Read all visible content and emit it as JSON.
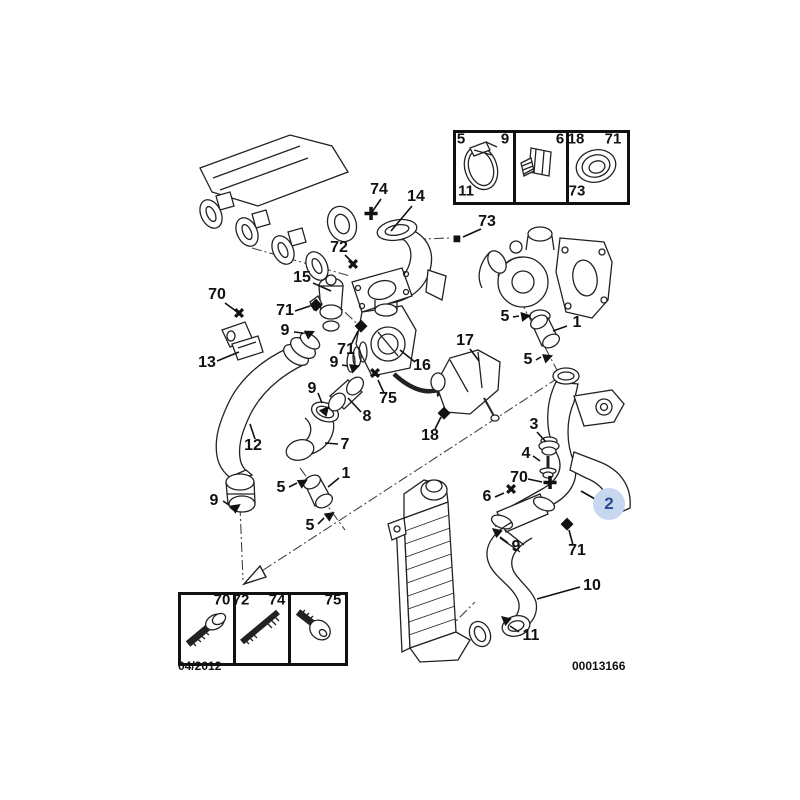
{
  "meta": {
    "date": "04/2012",
    "doc_number": "00013166"
  },
  "colors": {
    "line": "#222222",
    "background": "#ffffff",
    "highlight_circle": "#c7d7ef",
    "highlight_text": "#2a4a8c"
  },
  "icons": {
    "clamp_arrow": "▶",
    "screw_cross": "✖",
    "stud_plus": "✚",
    "seal_diamond": "◆",
    "nut_square": "■"
  },
  "highlighted_callout": {
    "label": "2"
  },
  "callouts": [
    {
      "label": "74",
      "marker": "stud_plus"
    },
    {
      "label": "14",
      "marker": "none"
    },
    {
      "label": "73",
      "marker": "nut_square"
    },
    {
      "label": "72",
      "marker": "screw_cross"
    },
    {
      "label": "15",
      "marker": "none"
    },
    {
      "label": "70",
      "marker": "screw_cross"
    },
    {
      "label": "71",
      "marker": "seal_diamond"
    },
    {
      "label": "9",
      "marker": "clamp_arrow"
    },
    {
      "label": "13",
      "marker": "none"
    },
    {
      "label": "71",
      "marker": "seal_diamond"
    },
    {
      "label": "9",
      "marker": "clamp_arrow"
    },
    {
      "label": "16",
      "marker": "none"
    },
    {
      "label": "75",
      "marker": "screw_cross"
    },
    {
      "label": "9",
      "marker": "clamp_arrow"
    },
    {
      "label": "8",
      "marker": "none"
    },
    {
      "label": "17",
      "marker": "none"
    },
    {
      "label": "18",
      "marker": "seal_diamond"
    },
    {
      "label": "7",
      "marker": "none"
    },
    {
      "label": "12",
      "marker": "none"
    },
    {
      "label": "5",
      "marker": "clamp_arrow"
    },
    {
      "label": "1",
      "marker": "none"
    },
    {
      "label": "9",
      "marker": "clamp_arrow"
    },
    {
      "label": "5",
      "marker": "clamp_arrow"
    },
    {
      "label": "5",
      "marker": "clamp_arrow"
    },
    {
      "label": "1",
      "marker": "none"
    },
    {
      "label": "5",
      "marker": "clamp_arrow"
    },
    {
      "label": "3",
      "marker": "none"
    },
    {
      "label": "4",
      "marker": "none"
    },
    {
      "label": "70",
      "marker": "stud_plus"
    },
    {
      "label": "6",
      "marker": "screw_cross"
    },
    {
      "label": "71",
      "marker": "seal_diamond"
    },
    {
      "label": "9",
      "marker": "clamp_arrow"
    },
    {
      "label": "10",
      "marker": "none"
    },
    {
      "label": "11",
      "marker": "clamp_arrow"
    }
  ],
  "inset_top_right": {
    "cell1": {
      "top_left": "5",
      "top_right": "9",
      "bottom_left": "11",
      "part": "hose-clamp"
    },
    "cell2": {
      "top_right": "6",
      "part": "threaded-adapter"
    },
    "cell3": {
      "top_left": "18",
      "top_right": "71",
      "bottom_left": "73",
      "part": "seal-grommet"
    }
  },
  "inset_bottom_left": {
    "cell1": {
      "top_right": "70",
      "part": "flange-screw"
    },
    "cell2": {
      "top_left": "72",
      "top_right": "74",
      "part": "double-stud"
    },
    "cell3": {
      "top_right": "75",
      "part": "socket-screw"
    }
  }
}
